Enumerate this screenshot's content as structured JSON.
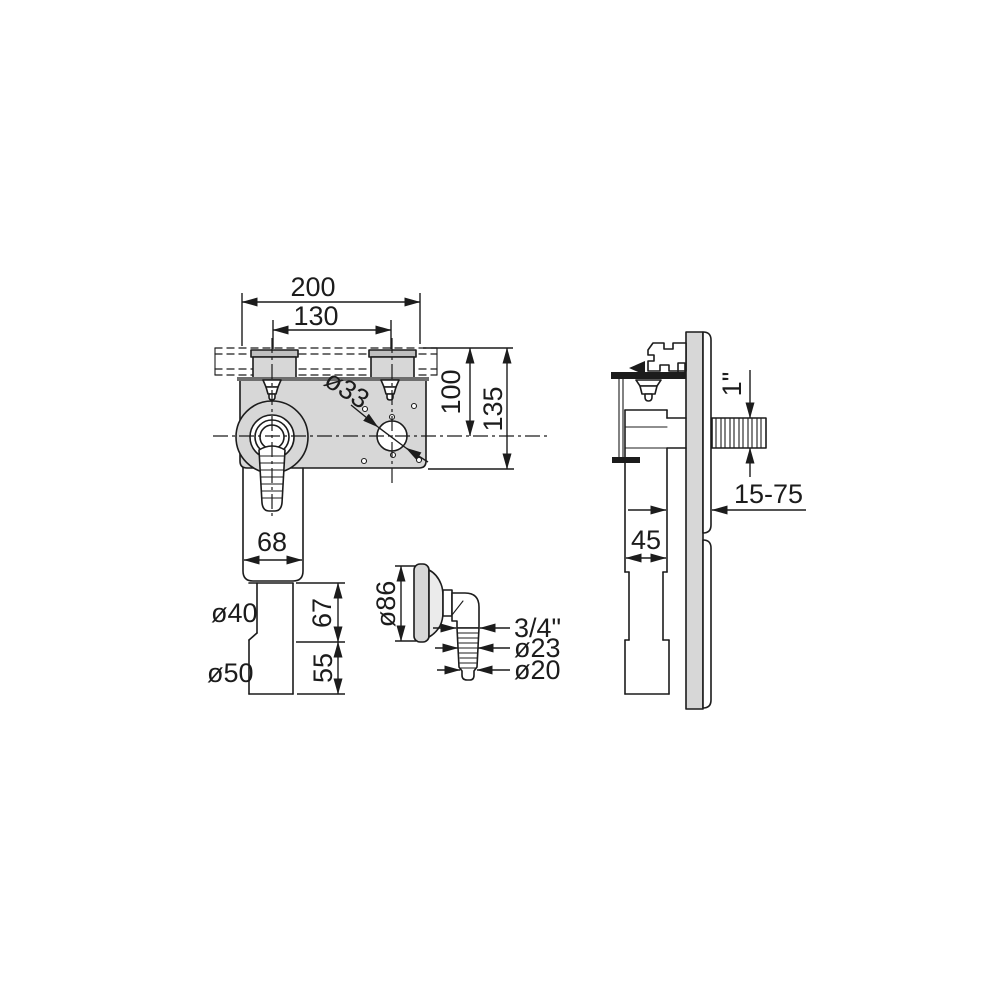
{
  "drawing": {
    "type": "technical-dimension-drawing",
    "subject": "concealed washing-machine trap with cover plate, hose elbow detail and side view",
    "labels": {
      "front": {
        "overall_width": "200",
        "screw_spacing": "130",
        "rail_to_axis": "100",
        "rail_to_plate_edge": "135",
        "knockout_dia": "ø33",
        "housing_width": "68",
        "outlet_dia": "ø40",
        "sleeve_dia": "ø50",
        "outlet_length": "67",
        "sleeve_length": "55"
      },
      "elbow_detail": {
        "flange_dia": "ø86",
        "thread": "3/4\"",
        "barb_dia_upper": "ø23",
        "barb_dia_lower": "ø20"
      },
      "side": {
        "inlet_thread": "1\"",
        "wall_depth_range": "15-75",
        "housing_depth": "45"
      }
    },
    "colors": {
      "line": "#1c1c1c",
      "fill_gray": "#d7d7d7",
      "fill_gray_dark": "#bfbfbf",
      "fill_light": "#ebebeb",
      "edge_dark": "#6e6e6e",
      "background": "#ffffff"
    }
  }
}
